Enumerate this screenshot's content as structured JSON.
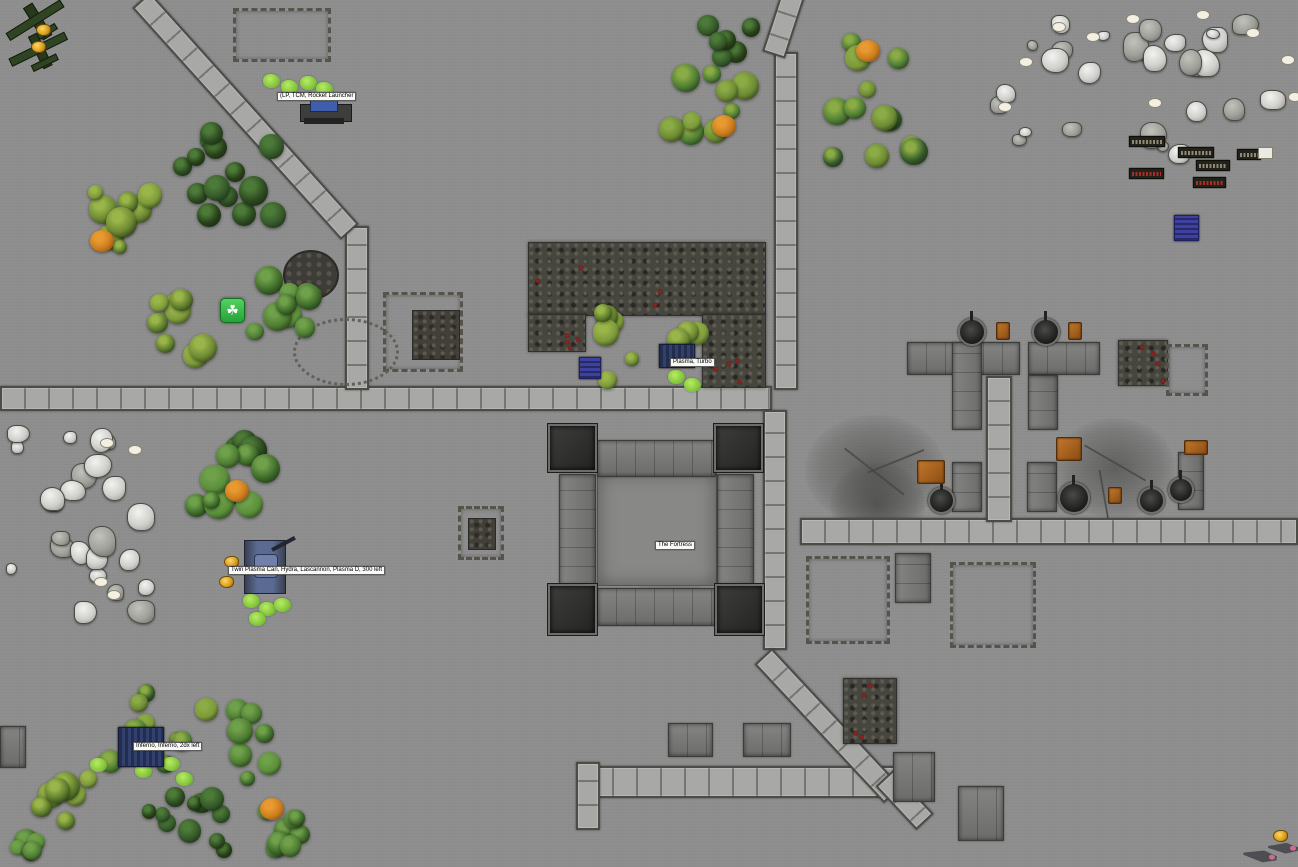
{
  "app": {
    "name": "Tabletop wargame battle map"
  },
  "labels": [
    {
      "text": "(LP, TCM, Rocket Launcher",
      "x": 277,
      "y": 92
    },
    {
      "text": "Plasma, Turbo",
      "x": 670,
      "y": 358
    },
    {
      "text": "The Fortress",
      "x": 655,
      "y": 541
    },
    {
      "text": "Twin Plasma Can, Hydra, Lascannon, Plasma D, 300 left",
      "x": 228,
      "y": 566
    },
    {
      "text": "Inferno, Inferno, 2dx left",
      "x": 133,
      "y": 742
    }
  ],
  "unit_plates": [
    {
      "x": 1129,
      "y": 136,
      "w": 34,
      "h": 9,
      "color": "gray"
    },
    {
      "x": 1178,
      "y": 147,
      "w": 34,
      "h": 9,
      "color": "gray"
    },
    {
      "x": 1237,
      "y": 149,
      "w": 22,
      "h": 9,
      "color": "gray",
      "whitebox": {
        "x": 1258,
        "y": 147,
        "w": 13,
        "h": 10
      }
    },
    {
      "x": 1196,
      "y": 160,
      "w": 32,
      "h": 9,
      "color": "gray"
    },
    {
      "x": 1129,
      "y": 168,
      "w": 33,
      "h": 9,
      "color": "red"
    },
    {
      "x": 1193,
      "y": 177,
      "w": 31,
      "h": 9,
      "color": "red"
    }
  ],
  "tokens": {
    "green_marker": {
      "x": 220,
      "y": 298,
      "glyph": "☘"
    },
    "blue_tokens": [
      {
        "x": 579,
        "y": 357,
        "w": 20,
        "h": 20
      },
      {
        "x": 1174,
        "y": 215,
        "w": 23,
        "h": 24
      }
    ],
    "gold_markers": [
      {
        "x": 36,
        "y": 24
      },
      {
        "x": 31,
        "y": 41
      },
      {
        "x": 224,
        "y": 556
      },
      {
        "x": 219,
        "y": 576
      },
      {
        "x": 1273,
        "y": 830
      }
    ],
    "planes": [
      {
        "x": 4,
        "y": 4,
        "w": 62,
        "h": 36,
        "rot": -32
      },
      {
        "x": 8,
        "y": 34,
        "w": 60,
        "h": 34,
        "rot": -26
      }
    ],
    "jets": [
      {
        "x": 1243,
        "y": 846,
        "w": 34,
        "h": 20,
        "rot": 8
      },
      {
        "x": 1268,
        "y": 839,
        "w": 30,
        "h": 18,
        "rot": 4
      }
    ],
    "tank_large": {
      "x": 238,
      "y": 540,
      "w": 62,
      "h": 56
    },
    "tank_small": {
      "x": 659,
      "y": 344,
      "w": 34,
      "h": 22
    },
    "tank_inferno": {
      "x": 118,
      "y": 727,
      "w": 44,
      "h": 38
    },
    "artillery": {
      "x": 300,
      "y": 96,
      "w": 50,
      "h": 30
    }
  },
  "terrain": {
    "roads": [
      {
        "x": 0,
        "y": 386,
        "w": 772,
        "h": 25,
        "dir": "h"
      },
      {
        "x": 345,
        "y": 226,
        "w": 24,
        "h": 164,
        "dir": "v"
      },
      {
        "x": 774,
        "y": 52,
        "w": 24,
        "h": 338,
        "dir": "v"
      },
      {
        "x": 763,
        "y": 410,
        "w": 24,
        "h": 240,
        "dir": "v"
      },
      {
        "x": 800,
        "y": 518,
        "w": 498,
        "h": 27,
        "dir": "h"
      },
      {
        "x": 986,
        "y": 376,
        "w": 26,
        "h": 146,
        "dir": "v"
      },
      {
        "x": 588,
        "y": 766,
        "w": 312,
        "h": 32,
        "dir": "h"
      },
      {
        "x": 576,
        "y": 762,
        "w": 24,
        "h": 68,
        "dir": "v"
      }
    ],
    "diag_roads": [
      {
        "x": 150,
        "y": -8,
        "len": 312,
        "angle": 48,
        "w": 24
      },
      {
        "x": 806,
        "y": -6,
        "len": 68,
        "angle": 108,
        "w": 24
      },
      {
        "x": 772,
        "y": 648,
        "len": 190,
        "angle": 47,
        "w": 24
      },
      {
        "x": 893,
        "y": 770,
        "len": 60,
        "angle": 47,
        "w": 24
      }
    ],
    "buildings": [
      {
        "x": 597,
        "y": 472,
        "w": 120,
        "h": 114,
        "variant": "court"
      },
      {
        "x": 597,
        "y": 440,
        "w": 119,
        "h": 37
      },
      {
        "x": 597,
        "y": 588,
        "w": 119,
        "h": 38
      },
      {
        "x": 559,
        "y": 474,
        "w": 37,
        "h": 112,
        "variant": "vpan"
      },
      {
        "x": 717,
        "y": 474,
        "w": 37,
        "h": 112,
        "variant": "vpan"
      },
      {
        "x": 907,
        "y": 342,
        "w": 113,
        "h": 33
      },
      {
        "x": 952,
        "y": 342,
        "w": 30,
        "h": 88,
        "variant": "vpan"
      },
      {
        "x": 1028,
        "y": 342,
        "w": 72,
        "h": 33
      },
      {
        "x": 1028,
        "y": 375,
        "w": 30,
        "h": 55,
        "variant": "vpan"
      },
      {
        "x": 952,
        "y": 462,
        "w": 30,
        "h": 50,
        "variant": "vpan"
      },
      {
        "x": 1027,
        "y": 462,
        "w": 30,
        "h": 50,
        "variant": "vpan"
      },
      {
        "x": 1178,
        "y": 452,
        "w": 26,
        "h": 58,
        "variant": "vpan"
      },
      {
        "x": 895,
        "y": 553,
        "w": 36,
        "h": 50,
        "variant": "vpan"
      },
      {
        "x": 668,
        "y": 723,
        "w": 45,
        "h": 34
      },
      {
        "x": 743,
        "y": 723,
        "w": 48,
        "h": 34
      },
      {
        "x": 893,
        "y": 752,
        "w": 42,
        "h": 50
      },
      {
        "x": 958,
        "y": 786,
        "w": 46,
        "h": 55
      },
      {
        "x": 0,
        "y": 726,
        "w": 26,
        "h": 42
      }
    ],
    "towers": [
      {
        "x": 548,
        "y": 424,
        "w": 49,
        "h": 48
      },
      {
        "x": 714,
        "y": 424,
        "w": 49,
        "h": 48
      },
      {
        "x": 548,
        "y": 584,
        "w": 49,
        "h": 51
      },
      {
        "x": 715,
        "y": 584,
        "w": 49,
        "h": 51
      }
    ],
    "ruins": [
      {
        "x": 233,
        "y": 8,
        "w": 98,
        "h": 54
      },
      {
        "x": 383,
        "y": 292,
        "w": 80,
        "h": 80,
        "core": {
          "x": 412,
          "y": 310,
          "w": 46,
          "h": 48
        }
      },
      {
        "x": 458,
        "y": 506,
        "w": 46,
        "h": 54,
        "core": {
          "x": 468,
          "y": 518,
          "w": 26,
          "h": 30
        }
      },
      {
        "x": 806,
        "y": 556,
        "w": 84,
        "h": 88
      },
      {
        "x": 950,
        "y": 562,
        "w": 86,
        "h": 86
      },
      {
        "x": 1166,
        "y": 344,
        "w": 42,
        "h": 52
      }
    ],
    "rubble": [
      {
        "x": 528,
        "y": 242,
        "w": 236,
        "h": 72
      },
      {
        "x": 702,
        "y": 314,
        "w": 62,
        "h": 72
      },
      {
        "x": 528,
        "y": 314,
        "w": 56,
        "h": 36
      },
      {
        "x": 843,
        "y": 678,
        "w": 52,
        "h": 64
      },
      {
        "x": 1118,
        "y": 340,
        "w": 48,
        "h": 44
      }
    ],
    "craters": [
      {
        "x": 805,
        "y": 415,
        "w": 140,
        "h": 110
      },
      {
        "x": 1055,
        "y": 418,
        "w": 120,
        "h": 100
      },
      {
        "x": 605,
        "y": 470,
        "w": 130,
        "h": 125
      },
      {
        "x": 830,
        "y": 462,
        "w": 95,
        "h": 85
      }
    ],
    "cracks": [
      {
        "x": 622,
        "y": 498,
        "len": 85,
        "angle": -28
      },
      {
        "x": 655,
        "y": 545,
        "len": 95,
        "angle": 18
      },
      {
        "x": 688,
        "y": 512,
        "len": 55,
        "angle": 72
      },
      {
        "x": 845,
        "y": 448,
        "len": 75,
        "angle": 38
      },
      {
        "x": 868,
        "y": 472,
        "len": 60,
        "angle": -22
      },
      {
        "x": 1085,
        "y": 445,
        "len": 70,
        "angle": 30
      },
      {
        "x": 1100,
        "y": 470,
        "len": 55,
        "angle": 80
      }
    ],
    "turrets": [
      {
        "x": 958,
        "y": 318,
        "s": 24
      },
      {
        "x": 1032,
        "y": 318,
        "s": 24
      },
      {
        "x": 928,
        "y": 487,
        "s": 23
      },
      {
        "x": 1058,
        "y": 482,
        "s": 28
      },
      {
        "x": 1138,
        "y": 487,
        "s": 23
      },
      {
        "x": 1168,
        "y": 477,
        "s": 22
      }
    ],
    "crates": [
      {
        "x": 996,
        "y": 322,
        "w": 12,
        "h": 16
      },
      {
        "x": 1068,
        "y": 322,
        "w": 12,
        "h": 16
      },
      {
        "x": 917,
        "y": 460,
        "w": 26,
        "h": 22
      },
      {
        "x": 1056,
        "y": 437,
        "w": 24,
        "h": 22
      },
      {
        "x": 1184,
        "y": 440,
        "w": 22,
        "h": 13
      },
      {
        "x": 1108,
        "y": 487,
        "w": 12,
        "h": 15
      }
    ],
    "tree_clusters": [
      {
        "x": 168,
        "y": 118,
        "w": 145,
        "h": 110,
        "count": 14,
        "palette": "dark",
        "seed": 1
      },
      {
        "x": 82,
        "y": 180,
        "w": 82,
        "h": 108,
        "count": 9,
        "palette": "olive",
        "seed": 2,
        "orange": [
          90,
          230
        ]
      },
      {
        "x": 138,
        "y": 288,
        "w": 82,
        "h": 88,
        "count": 8,
        "palette": "olive",
        "seed": 3
      },
      {
        "x": 240,
        "y": 262,
        "w": 95,
        "h": 80,
        "count": 9,
        "palette": "green",
        "seed": 4
      },
      {
        "x": 218,
        "y": 424,
        "w": 55,
        "h": 45,
        "count": 5,
        "palette": "dark",
        "seed": 5
      },
      {
        "x": 185,
        "y": 430,
        "w": 100,
        "h": 92,
        "count": 9,
        "palette": "green",
        "seed": 6,
        "orange": [
          225,
          480
        ]
      },
      {
        "x": 588,
        "y": 293,
        "w": 52,
        "h": 98,
        "count": 6,
        "palette": "olive",
        "seed": 7
      },
      {
        "x": 662,
        "y": 320,
        "w": 52,
        "h": 32,
        "count": 4,
        "palette": "olive",
        "seed": 8
      },
      {
        "x": 655,
        "y": 60,
        "w": 115,
        "h": 90,
        "count": 10,
        "palette": "mixed",
        "seed": 9,
        "orange": [
          712,
          115
        ]
      },
      {
        "x": 686,
        "y": 12,
        "w": 78,
        "h": 58,
        "count": 7,
        "palette": "dark",
        "seed": 10
      },
      {
        "x": 815,
        "y": 25,
        "w": 128,
        "h": 165,
        "count": 13,
        "palette": "mixed",
        "seed": 11,
        "orange": [
          856,
          40
        ]
      },
      {
        "x": 96,
        "y": 680,
        "w": 122,
        "h": 98,
        "count": 10,
        "palette": "mixed",
        "seed": 12
      },
      {
        "x": 222,
        "y": 695,
        "w": 78,
        "h": 98,
        "count": 8,
        "palette": "green",
        "seed": 13
      },
      {
        "x": 26,
        "y": 770,
        "w": 98,
        "h": 62,
        "count": 7,
        "palette": "olive",
        "seed": 14
      },
      {
        "x": 118,
        "y": 786,
        "w": 118,
        "h": 81,
        "count": 11,
        "palette": "dark",
        "seed": 15
      },
      {
        "x": 226,
        "y": 803,
        "w": 88,
        "h": 62,
        "count": 8,
        "palette": "green",
        "seed": 16,
        "orange": [
          260,
          798
        ]
      },
      {
        "x": 0,
        "y": 826,
        "w": 52,
        "h": 41,
        "count": 5,
        "palette": "green",
        "seed": 17
      }
    ],
    "bushes": [
      {
        "x": 263,
        "y": 74
      },
      {
        "x": 281,
        "y": 80
      },
      {
        "x": 300,
        "y": 76
      },
      {
        "x": 316,
        "y": 82
      },
      {
        "x": 668,
        "y": 370
      },
      {
        "x": 684,
        "y": 378
      },
      {
        "x": 243,
        "y": 594
      },
      {
        "x": 259,
        "y": 602
      },
      {
        "x": 274,
        "y": 598
      },
      {
        "x": 249,
        "y": 612
      },
      {
        "x": 90,
        "y": 758
      },
      {
        "x": 163,
        "y": 757
      },
      {
        "x": 176,
        "y": 772
      },
      {
        "x": 135,
        "y": 764
      }
    ],
    "rock_fields": [
      {
        "x": 2,
        "y": 420,
        "w": 165,
        "h": 212,
        "count": 24,
        "seed": 21
      },
      {
        "x": 988,
        "y": 14,
        "w": 300,
        "h": 150,
        "count": 28,
        "seed": 22
      }
    ],
    "egg_rocks": [
      {
        "x": 100,
        "y": 438
      },
      {
        "x": 128,
        "y": 445
      },
      {
        "x": 94,
        "y": 577
      },
      {
        "x": 107,
        "y": 590
      },
      {
        "x": 998,
        "y": 102
      },
      {
        "x": 1019,
        "y": 57
      },
      {
        "x": 1086,
        "y": 32
      },
      {
        "x": 1126,
        "y": 14
      },
      {
        "x": 1196,
        "y": 10
      },
      {
        "x": 1246,
        "y": 28
      },
      {
        "x": 1281,
        "y": 55
      },
      {
        "x": 1288,
        "y": 92
      },
      {
        "x": 1148,
        "y": 98
      },
      {
        "x": 1052,
        "y": 22
      }
    ],
    "circles": [
      {
        "x": 283,
        "y": 250,
        "w": 52,
        "h": 46,
        "type": "filled"
      },
      {
        "x": 293,
        "y": 318,
        "w": 100,
        "h": 62,
        "type": "ring"
      }
    ]
  },
  "colors": {
    "ground": "#8e8e8e",
    "road": "#a8a8a6",
    "plate_text_gray": "#a19a85",
    "plate_text_red": "#c03028",
    "accent_green_marker": "#27a238",
    "accent_gold": "#d79b22",
    "token_blue": "#3e41a0",
    "tree_orange": "#cc7d1e"
  }
}
